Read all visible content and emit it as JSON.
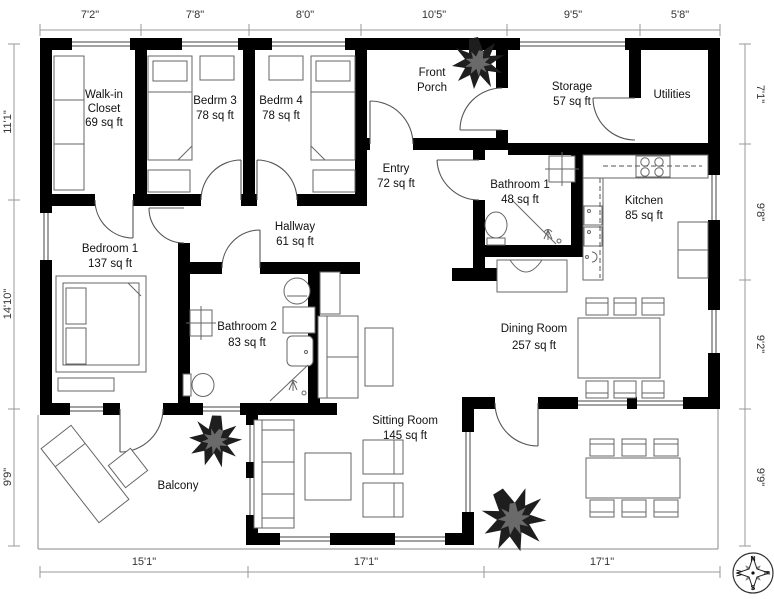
{
  "rooms": {
    "walk_in_closet": {
      "name_line1": "Walk-in",
      "name_line2": "Closet",
      "area": "69 sq ft"
    },
    "bedrm3": {
      "name": "Bedrm 3",
      "area": "78 sq ft"
    },
    "bedrm4": {
      "name": "Bedrm 4",
      "area": "78 sq ft"
    },
    "front_porch": {
      "name_line1": "Front",
      "name_line2": "Porch"
    },
    "storage": {
      "name": "Storage",
      "area": "57 sq ft"
    },
    "utilities": {
      "name": "Utilities"
    },
    "entry": {
      "name": "Entry",
      "area": "72 sq ft"
    },
    "bathroom1": {
      "name": "Bathroom 1",
      "area": "48 sq ft"
    },
    "kitchen": {
      "name": "Kitchen",
      "area": "85 sq ft"
    },
    "hallway": {
      "name": "Hallway",
      "area": "61 sq ft"
    },
    "bedroom1": {
      "name": "Bedroom 1",
      "area": "137 sq ft"
    },
    "bathroom2": {
      "name": "Bathroom 2",
      "area": "83 sq ft"
    },
    "dining_room": {
      "name": "Dining Room",
      "area": "257 sq ft"
    },
    "sitting_room": {
      "name": "Sitting Room",
      "area": "145 sq ft"
    },
    "balcony": {
      "name": "Balcony"
    }
  },
  "dimensions": {
    "top": [
      "7'2\"",
      "7'8\"",
      "8'0\"",
      "10'5\"",
      "9'5\"",
      "5'8\""
    ],
    "left": [
      "11'1\"",
      "14'10\"",
      "9'9\""
    ],
    "right": [
      "7'1\"",
      "9'8\"",
      "9'2\"",
      "9'9\""
    ],
    "bottom": [
      "15'1\"",
      "17'1\"",
      "17'1\""
    ]
  },
  "compass": {
    "north": "N",
    "east": "E",
    "south": "S",
    "west": "W"
  }
}
